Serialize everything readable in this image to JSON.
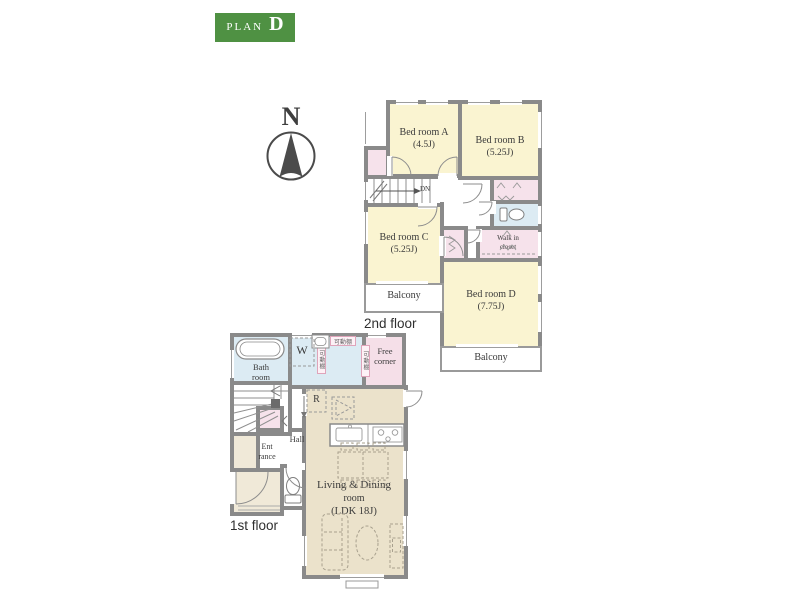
{
  "badge": {
    "prefix": "PLAN",
    "letter": "D"
  },
  "compass": {
    "north": "N"
  },
  "floor2": {
    "caption": "2nd floor",
    "bed_a_name": "Bed room A",
    "bed_a_size": "(4.5J)",
    "bed_b_name": "Bed room B",
    "bed_b_size": "(5.25J)",
    "bed_c_name": "Bed room C",
    "bed_c_size": "(5.25J)",
    "bed_d_name": "Bed room D",
    "bed_d_size": "(7.75J)",
    "wic_line1": "Walk in",
    "wic_line2": "closet",
    "balcony_left": "Balcony",
    "balcony_bottom": "Balcony",
    "stairs_down": "DN"
  },
  "floor1": {
    "caption": "1st floor",
    "bath_line1": "Bath",
    "bath_line2": "room",
    "washer": "W",
    "fridge": "R",
    "free_line1": "Free",
    "free_line2": "corner",
    "entrance_line1": "Ent",
    "entrance_line2": "rance",
    "hall": "Hall",
    "living_line1": "Living & Dining",
    "living_line2": "room",
    "living_line3": "(LDK 18J)",
    "shelf_top": "可動棚",
    "shelf_left": "可動棚",
    "shelf_right": "可動棚"
  },
  "colors": {
    "wall": "#8a8a8a",
    "bedroom_yellow": "#faf4d1",
    "living_beige": "#ebe2cb",
    "water_blue": "#dcebf3",
    "closet_pink": "#f6e2eb",
    "free_corner_pink": "#f5dfe8",
    "badge_green": "#4f9143",
    "line_gray": "#777777"
  }
}
